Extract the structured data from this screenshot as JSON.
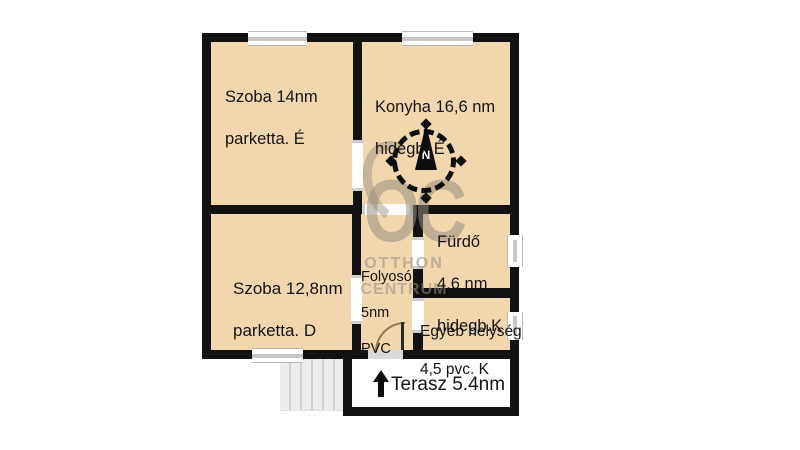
{
  "floorplan": {
    "rooms": {
      "szoba14": {
        "line1": "Szoba 14nm",
        "line2": "parketta. É"
      },
      "konyha": {
        "line1": "Konyha 16,6 nm",
        "line2": "hidegb. É"
      },
      "szoba128": {
        "line1": "Szoba 12,8nm",
        "line2": "parketta. D"
      },
      "folyoso": {
        "line1": "Folyosó",
        "line2": "5nm",
        "line3": "PVC"
      },
      "furdo": {
        "line1": "Fürdő",
        "line2": "4,6 nm",
        "line3": "hidegb.K"
      },
      "egyeb": {
        "line1": "Egyéb helység",
        "line2": "4,5 pvc. K"
      },
      "terasz": {
        "label": "Terasz 5.4nm"
      }
    },
    "compass": {
      "north_label": "N"
    },
    "watermark": {
      "logo": "OC",
      "line1": "OTTHON",
      "line2": "CENTRUM"
    },
    "colors": {
      "room_fill": "#f0d7ae",
      "wall": "#121212",
      "watermark_gray": "#978d7e",
      "window_gray": "#c7c7c7",
      "stairs_gray": "#ededed"
    }
  }
}
